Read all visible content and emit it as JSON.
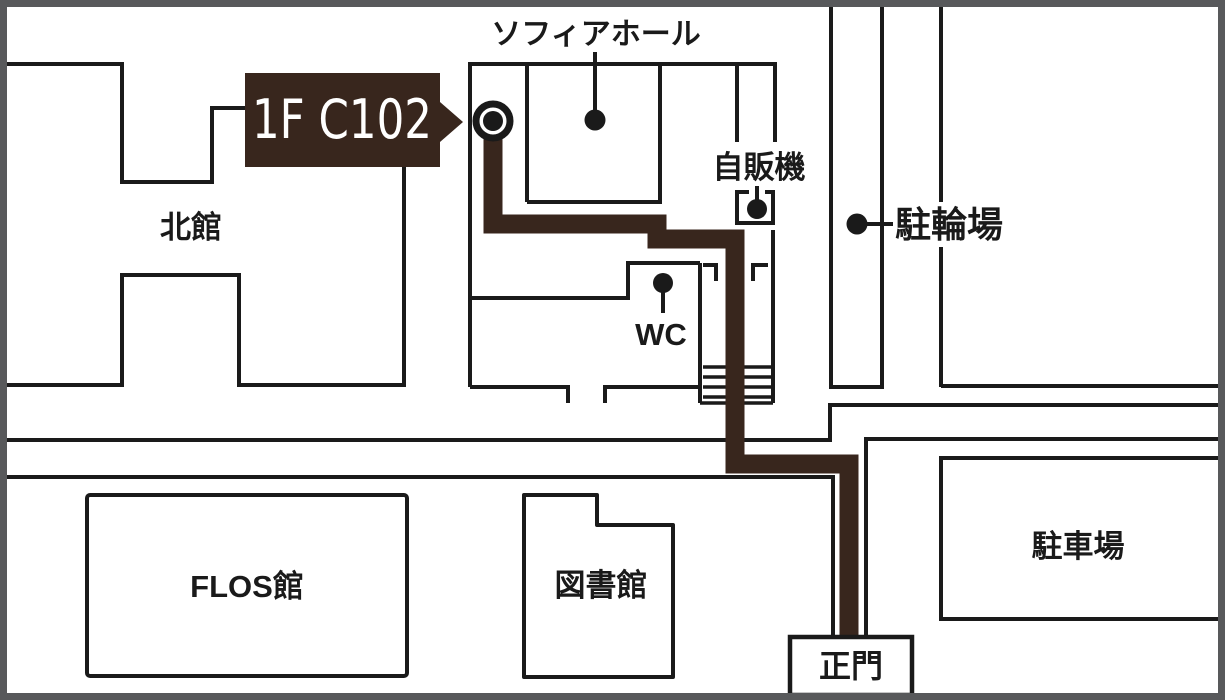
{
  "map": {
    "badge": {
      "label": "1F C102"
    },
    "labels": {
      "sophia_hall": "ソフィアホール",
      "north_building": "北館",
      "vending_machine": "自販機",
      "bicycle_parking": "駐輪場",
      "toilet": "WC",
      "flos_building": "FLOS館",
      "library": "図書館",
      "car_parking": "駐車場",
      "main_gate": "正門"
    },
    "colors": {
      "ink": "#1a1a1a",
      "route": "#38261d",
      "frame": "#58595b",
      "bg": "#ffffff"
    }
  }
}
